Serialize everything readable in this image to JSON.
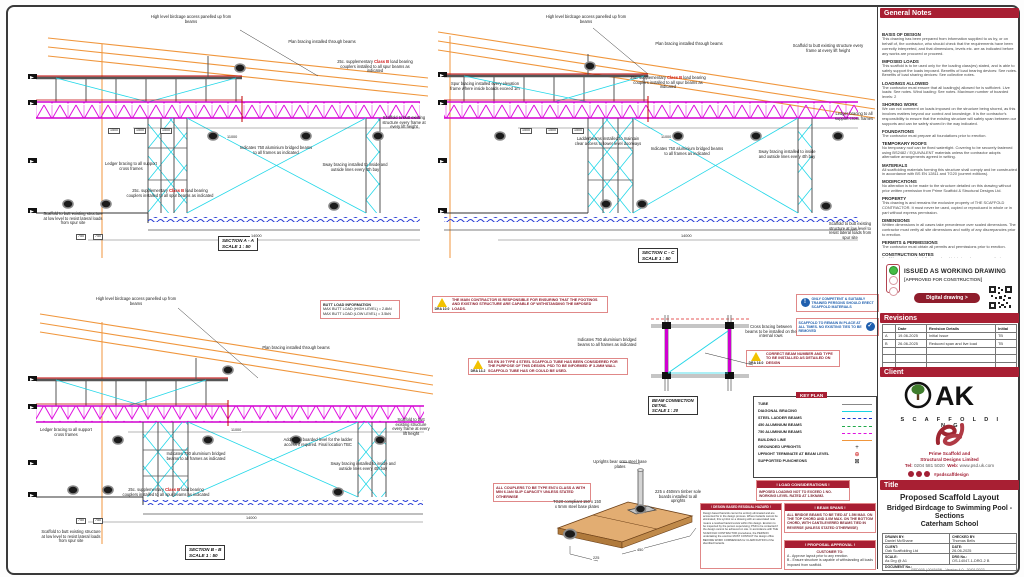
{
  "meta": {
    "footer": "PSD005 | 004545N   -   Version 4.0   -   30/01/2023"
  },
  "gn": {
    "title": "General Notes",
    "n0": {
      "h": "BASIS OF DESIGN",
      "b": "This drawing has been prepared from information supplied to us by, or on behalf of, the contractor, who should check that the requirements have been correctly interpreted, and that dimensions, levels etc. are as indicated before any works are procured or proceed."
    },
    "n1": {
      "h": "IMPOSED LOADS",
      "b": "This scaffold is to be used only for the loading class(es) stated, and is able to safely support the loads imposed. Benefits of load bearing devices: See notes. Benefits of load sharing devices: See collective notes."
    },
    "n2": {
      "h": "LOADINGS ALLOWED",
      "b": "The contractor must ensure that all loading(s) allowed for is sufficient. Live loads: See notes. Wind loading: See notes. Maximum number of boarded levels: 2"
    },
    "n3": {
      "h": "SHORING WORK",
      "b": "We can not comment on loads imposed on the structure being shored, as this involves matters beyond our control and knowledge. It is the contractor's responsibility to ensure that the existing structure will safely span between our supports and can be safely shored in the way indicated."
    },
    "n4": {
      "h": "FOUNDATIONS",
      "b": "The contractor must prepare all foundations prior to erection."
    },
    "n5": {
      "h": "TEMPORARY ROOFS",
      "b": "No temporary roof can be fixed watertight. Covering to be securely fastened using BS2482 / EQUIVALENT materials unless the contractor adopts alternative arrangements agreed in writing."
    },
    "n6": {
      "h": "MATERIALS",
      "b": "All scaffolding materials forming this structure shall comply and be constructed in accordance with BS EN 12811 and TG20 (current editions)."
    },
    "n7": {
      "h": "MODIFICATIONS",
      "b": "No alteration is to be made to the structure detailed on this drawing without prior written permission from Prime Scaffold & Structural Designs Ltd."
    },
    "n8": {
      "h": "PROPERTY",
      "b": "This drawing is and remains the exclusive property of THE SCAFFOLD CONTRACTOR. It must never be used, copied or reproduced in whole or in part without express permission."
    },
    "n9": {
      "h": "DIMENSIONS",
      "b": "Written dimensions in all cases take precedence over scaled dimensions. The contractor must verify all site dimensions and notify of any discrepancies prior to erection."
    },
    "n10": {
      "h": "PERMITS & PERMISSIONS",
      "b": "The contractor must obtain all permits and permissions prior to erection."
    },
    "cn": {
      "h": "CONSTRUCTION NOTES",
      "i0": "All bracing must be fully braced and joint pinned, as per manufacturer guidance and TG20 guidelines.",
      "i1": "Unless stated otherwise, all ties/infills are to be installed using load bearing couplers.",
      "i2": "Unless stated otherwise, maximum transom spacing is not to exceed 1.2m c/c.",
      "i3": "All joints and couplers are to be staggered in accordance with TG20, unless noted otherwise.",
      "i4": "All contractors to consider all existing services when founding uprights.",
      "i5": "Main contractor to provide a minimal, adequate foundation.",
      "i6": "No position or loading to be altered without prior written permission from Prime Scaffold & Structural Designs Ltd."
    }
  },
  "issued": {
    "l1": "ISSUED AS WORKING DRAWING",
    "l2": "[APPROVED FOR CONSTRUCTION]",
    "btn": "Digital drawing >"
  },
  "rev": {
    "title": "Revisions",
    "h0": "",
    "h1": "Date",
    "h2": "Revision Details",
    "h3": "Initial",
    "r0": {
      "rev": "A",
      "date": "19-06-2025",
      "det": "Initial Issue",
      "ini": "TB"
    },
    "r1": {
      "rev": "B",
      "date": "26-06-2025",
      "det": "Reduced span and live load",
      "ini": "TB"
    }
  },
  "client": {
    "title": "Client",
    "ak": "AK",
    "sub": "S C A F F O L D I N G"
  },
  "psd": {
    "n1": "Prime Scaffold and",
    "n2": "Structural Designs Limited",
    "telL": "Tel:",
    "tel": "0204 581 5020",
    "webL": "Web:",
    "web": "www.psd.uk.com",
    "tag": "#psdscaffdesign"
  },
  "ttl": {
    "title": "Title",
    "l1": "Proposed Scaffold Layout",
    "l2": "Bridged Birdcage to Swimming Pool - Sections",
    "l3": "Caterham School"
  },
  "info": {
    "dL": "DRAWN BY:",
    "d": "Daniel McShane",
    "cL": "CHECKED BY:",
    "c": "Thomas Bells",
    "clL": "CLIENT:",
    "cl": "Oak Scaffolding Ltd",
    "daL": "DATE:",
    "da": "26-06-2025",
    "sL": "SCALE:",
    "s": "As Drg @ A1",
    "gL": "DRG No.:",
    "g": "OS-14047-1-DRG-2 B",
    "docL": "DOCUMENT No.:"
  },
  "common": {
    "highlevel": "High level birdcage access panelled up from beams",
    "planbrace": "Plan bracing installed through beams",
    "ledger": "Ledger bracing to all support cross frames",
    "ind750": "Indicates 750 aluminium bridged beams to all frames as indicated",
    "sway": "Sway bracing installed to inside and outside lines every 4th bay",
    "butt_low": "Scaffold to butt existing structure at low level to resist lateral loads from spur site",
    "butt_frame": "Scaffold to butt existing structure every frame at every lift height",
    "scale50": "SCALE  1 : 50"
  },
  "suppl": {
    "pre": "25c. supplementary ",
    "red": "Class B",
    "post": " load bearing couplers installed to all spur beams as indicated"
  },
  "sec": {
    "aa": {
      "label": "SECTION A - A"
    },
    "cc": {
      "label": "SECTION C - C",
      "spur": "Spur bracing installed every elevation frame where inside boards exceed 1m",
      "ladder": "Ladderbeams installed to maintain clear access to lower level doorways"
    },
    "bb": {
      "label": "SECTION B - B",
      "added": "Additional boarded level for the ladder access if required. Final location TBC",
      "butt": {
        "t": "BUTT LOAD INFORMATION",
        "l1": "MAX BUTT LOAD (HIGH LEVEL) = 2.8kN",
        "l2": "MAX BUTT LOAD (LOW LEVEL) = 3.5kN"
      }
    }
  },
  "dims": {
    "d1500": "1500",
    "d11000": "11000",
    "d14000": "14000",
    "d750": "750",
    "d450": "450",
    "d225": "225"
  },
  "boxes": {
    "dra1": {
      "code": "DRA 10.0",
      "text": "The main contractor is responsible for ensuring that the footings and existing structure are capable of withstanding the imposed loads."
    },
    "dra2": {
      "code": "DRA 13.2",
      "text": "BS EN 39 Type 4 steel scaffold tube has been considered for the purpose of this design. PSD to be informed if 3.2mm wall scaffold tube has or could be used."
    },
    "dra3": {
      "code": "DRA 16.0",
      "text": "Correct beam number and type to be installed as detailed on design"
    },
    "mand1": "Only competent & suitably trained persons should erect scaffold materials",
    "mand2": "Scaffold to remain in place at all times. No existing ties to be removed",
    "cross": "Cross bracing between beams to be installed on the internal rows",
    "coup": "ALL COUPLERS TO BE TYPE EN74 CLASS A WITH MIN 6.1kN SLIP CAPACITY UNLESS STATED OTHERWISE",
    "load": {
      "t": "! LOAD CONSIDERATIONS !",
      "b": "IMPOSED LOADING NOT TO EXCEED 1 NO. WORKING LEVEL RATED AT 1.5kN/m2."
    },
    "hazard": {
      "t": "! DESIGN BASED RESIDUAL HAZARD !",
      "b": "Design based hazards cannot be entirely eliminated and are accounted for in the design process. Where hazards cannot be eliminated, this symbol on a drawing with an associated note means a residual hazard exists within this design. Erection to be inspected by the person supervising; PSD to be contacted if the design cannot be achieved on site. In accordance with THE SCAFFOLD CONTRACTOR procedures, the PERSON undertaking the erection MUST CONTACT the design office BEFORE WORK COMMENCES for CLARIFICATION of the identified hazards."
    },
    "spans": {
      "t": "! BEAM SPANS !",
      "b": "ALL BRIDGE BEAMS TO BE TIED AT 1.5m MAX. ON THE TOP CHORD AND 3.0m MAX. ON THE BOTTOM CHORD, WITH CANTILEVERED BEAMS TIED IN REVERSE (UNLESS STATED OTHERWISE)"
    },
    "appr": {
      "t": "! PROPOSAL APPROVAL !",
      "lead": "CUSTOMER TO:",
      "a": "A -  Approve layout prior to any erection.",
      "b": "B -  Ensure structure is capable of withstanding all loads imposed from scaffold."
    }
  },
  "det": {
    "l1": "BEAM CONNECTION",
    "l2": "DETAIL",
    "l3": "SCALE  1 : 20"
  },
  "keyplan": {
    "title": "KEY PLAN"
  },
  "legend": {
    "items": [
      {
        "label": "TUBE"
      },
      {
        "label": "DIAGONAL BRACING"
      },
      {
        "label": "STEEL LADDER BEAMS"
      },
      {
        "label": "450 ALUMINIUM BEAMS"
      },
      {
        "label": "750 ALUMINIUM BEAMS"
      },
      {
        "label": "BUILDING LINE"
      },
      {
        "label": "GROUNDED UPRIGHTS",
        "sym": "+"
      },
      {
        "label": "UPRIGHT TERMINATE AT BEAM LEVEL",
        "sym": "⊕"
      },
      {
        "label": "SUPPORTED PUNCHEONS",
        "sym": "⊠"
      }
    ]
  },
  "sole": {
    "s1": "Uprights bear onto steel base plates",
    "s2": "TG20 compliant 150 x 150 x 5mm steel base plates",
    "s3": "225 x 450mm timber sole boards installed to all uprights"
  }
}
